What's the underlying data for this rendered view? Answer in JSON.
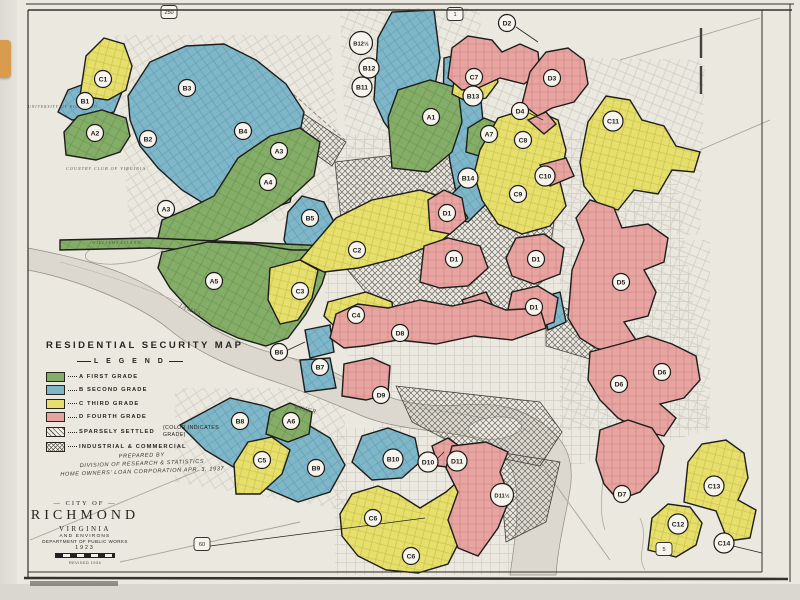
{
  "map": {
    "title": "RESIDENTIAL  SECURITY  MAP",
    "legend": {
      "heading": "L E G E N D",
      "grades": [
        {
          "label": "A FIRST GRADE",
          "color": "#84ae68"
        },
        {
          "label": "B SECOND GRADE",
          "color": "#7fb7c9"
        },
        {
          "label": "C THIRD GRADE",
          "color": "#e6df6b"
        },
        {
          "label": "D FOURTH GRADE",
          "color": "#e7a4a1"
        }
      ],
      "special": [
        {
          "label": "SPARSELY SETTLED",
          "note": "(COLOR INDICATES\nGRADE)"
        },
        {
          "label": "INDUSTRIAL & COMMERCIAL",
          "note": ""
        }
      ]
    },
    "credits": [
      "PREPARED BY",
      "DIVISION OF RESEARCH & STATISTICS",
      "HOME OWNERS' LOAN CORPORATION   APR. 3, 1937"
    ],
    "title_block": {
      "city_of": "— CITY OF —",
      "name": "RICHMOND",
      "state": "VIRGINIA",
      "environs": "AND ENVIRONS",
      "dept": "DEPARTMENT OF PUBLIC WORKS",
      "year": "1923",
      "revised": "REVISED 1934"
    },
    "zone_labels": [
      {
        "text": "A1",
        "x": 431,
        "y": 117
      },
      {
        "text": "A2",
        "x": 95,
        "y": 133
      },
      {
        "text": "A3",
        "x": 166,
        "y": 209
      },
      {
        "text": "A3",
        "x": 279,
        "y": 151
      },
      {
        "text": "A4",
        "x": 268,
        "y": 182
      },
      {
        "text": "A5",
        "x": 214,
        "y": 281
      },
      {
        "text": "A6",
        "x": 291,
        "y": 421
      },
      {
        "text": "A7",
        "x": 489,
        "y": 134
      },
      {
        "text": "B1",
        "x": 85,
        "y": 101
      },
      {
        "text": "B2",
        "x": 148,
        "y": 139
      },
      {
        "text": "B3",
        "x": 187,
        "y": 88
      },
      {
        "text": "B4",
        "x": 243,
        "y": 131
      },
      {
        "text": "B5",
        "x": 310,
        "y": 218
      },
      {
        "text": "B6",
        "x": 279,
        "y": 352
      },
      {
        "text": "B7",
        "x": 320,
        "y": 367
      },
      {
        "text": "B8",
        "x": 240,
        "y": 421
      },
      {
        "text": "B9",
        "x": 316,
        "y": 468
      },
      {
        "text": "B10",
        "x": 393,
        "y": 459
      },
      {
        "text": "B11",
        "x": 362,
        "y": 87
      },
      {
        "text": "B12",
        "x": 369,
        "y": 68
      },
      {
        "text": "B12½",
        "x": 361,
        "y": 43
      },
      {
        "text": "B13",
        "x": 473,
        "y": 96
      },
      {
        "text": "B14",
        "x": 468,
        "y": 178
      },
      {
        "text": "C1",
        "x": 103,
        "y": 79
      },
      {
        "text": "C2",
        "x": 357,
        "y": 250
      },
      {
        "text": "C3",
        "x": 300,
        "y": 291
      },
      {
        "text": "C4",
        "x": 356,
        "y": 315
      },
      {
        "text": "C5",
        "x": 262,
        "y": 460
      },
      {
        "text": "C6",
        "x": 373,
        "y": 518
      },
      {
        "text": "C6",
        "x": 411,
        "y": 556
      },
      {
        "text": "C7",
        "x": 474,
        "y": 77
      },
      {
        "text": "C8",
        "x": 523,
        "y": 140
      },
      {
        "text": "C9",
        "x": 518,
        "y": 194
      },
      {
        "text": "C10",
        "x": 545,
        "y": 176
      },
      {
        "text": "C11",
        "x": 613,
        "y": 121
      },
      {
        "text": "C12",
        "x": 678,
        "y": 524
      },
      {
        "text": "C13",
        "x": 714,
        "y": 486
      },
      {
        "text": "C14",
        "x": 724,
        "y": 543
      },
      {
        "text": "D1",
        "x": 447,
        "y": 213
      },
      {
        "text": "D1",
        "x": 454,
        "y": 259
      },
      {
        "text": "D1",
        "x": 536,
        "y": 259
      },
      {
        "text": "D1",
        "x": 534,
        "y": 307
      },
      {
        "text": "D2",
        "x": 507,
        "y": 23
      },
      {
        "text": "D3",
        "x": 552,
        "y": 78
      },
      {
        "text": "D4",
        "x": 520,
        "y": 111
      },
      {
        "text": "D5",
        "x": 621,
        "y": 282
      },
      {
        "text": "D6",
        "x": 619,
        "y": 384
      },
      {
        "text": "D6",
        "x": 662,
        "y": 372
      },
      {
        "text": "D7",
        "x": 622,
        "y": 494
      },
      {
        "text": "D8",
        "x": 400,
        "y": 333
      },
      {
        "text": "D9",
        "x": 381,
        "y": 395
      },
      {
        "text": "D10",
        "x": 428,
        "y": 462
      },
      {
        "text": "D11",
        "x": 457,
        "y": 461
      },
      {
        "text": "D11½",
        "x": 502,
        "y": 495
      }
    ],
    "route_shields": [
      {
        "number": "250",
        "x": 169,
        "y": 12
      },
      {
        "number": "1",
        "x": 455,
        "y": 14
      },
      {
        "number": "60",
        "x": 202,
        "y": 544
      },
      {
        "number": "5",
        "x": 664,
        "y": 549
      }
    ],
    "place_labels": [
      {
        "text": "UNIVERSITY OF RICHMOND",
        "x": 28,
        "y": 108,
        "size": 3.8,
        "rot": 0
      },
      {
        "text": "COUNTRY CLUB OF VIRGINIA",
        "x": 66,
        "y": 170,
        "size": 4.2,
        "rot": 0
      },
      {
        "text": "WILLIAMS ISLAND",
        "x": 92,
        "y": 244,
        "size": 4.2,
        "rot": 0
      },
      {
        "text": "JAMES",
        "x": 178,
        "y": 307,
        "size": 6.5,
        "rot": 22
      },
      {
        "text": "RIVER",
        "x": 294,
        "y": 409,
        "size": 6.5,
        "rot": 12
      }
    ]
  }
}
